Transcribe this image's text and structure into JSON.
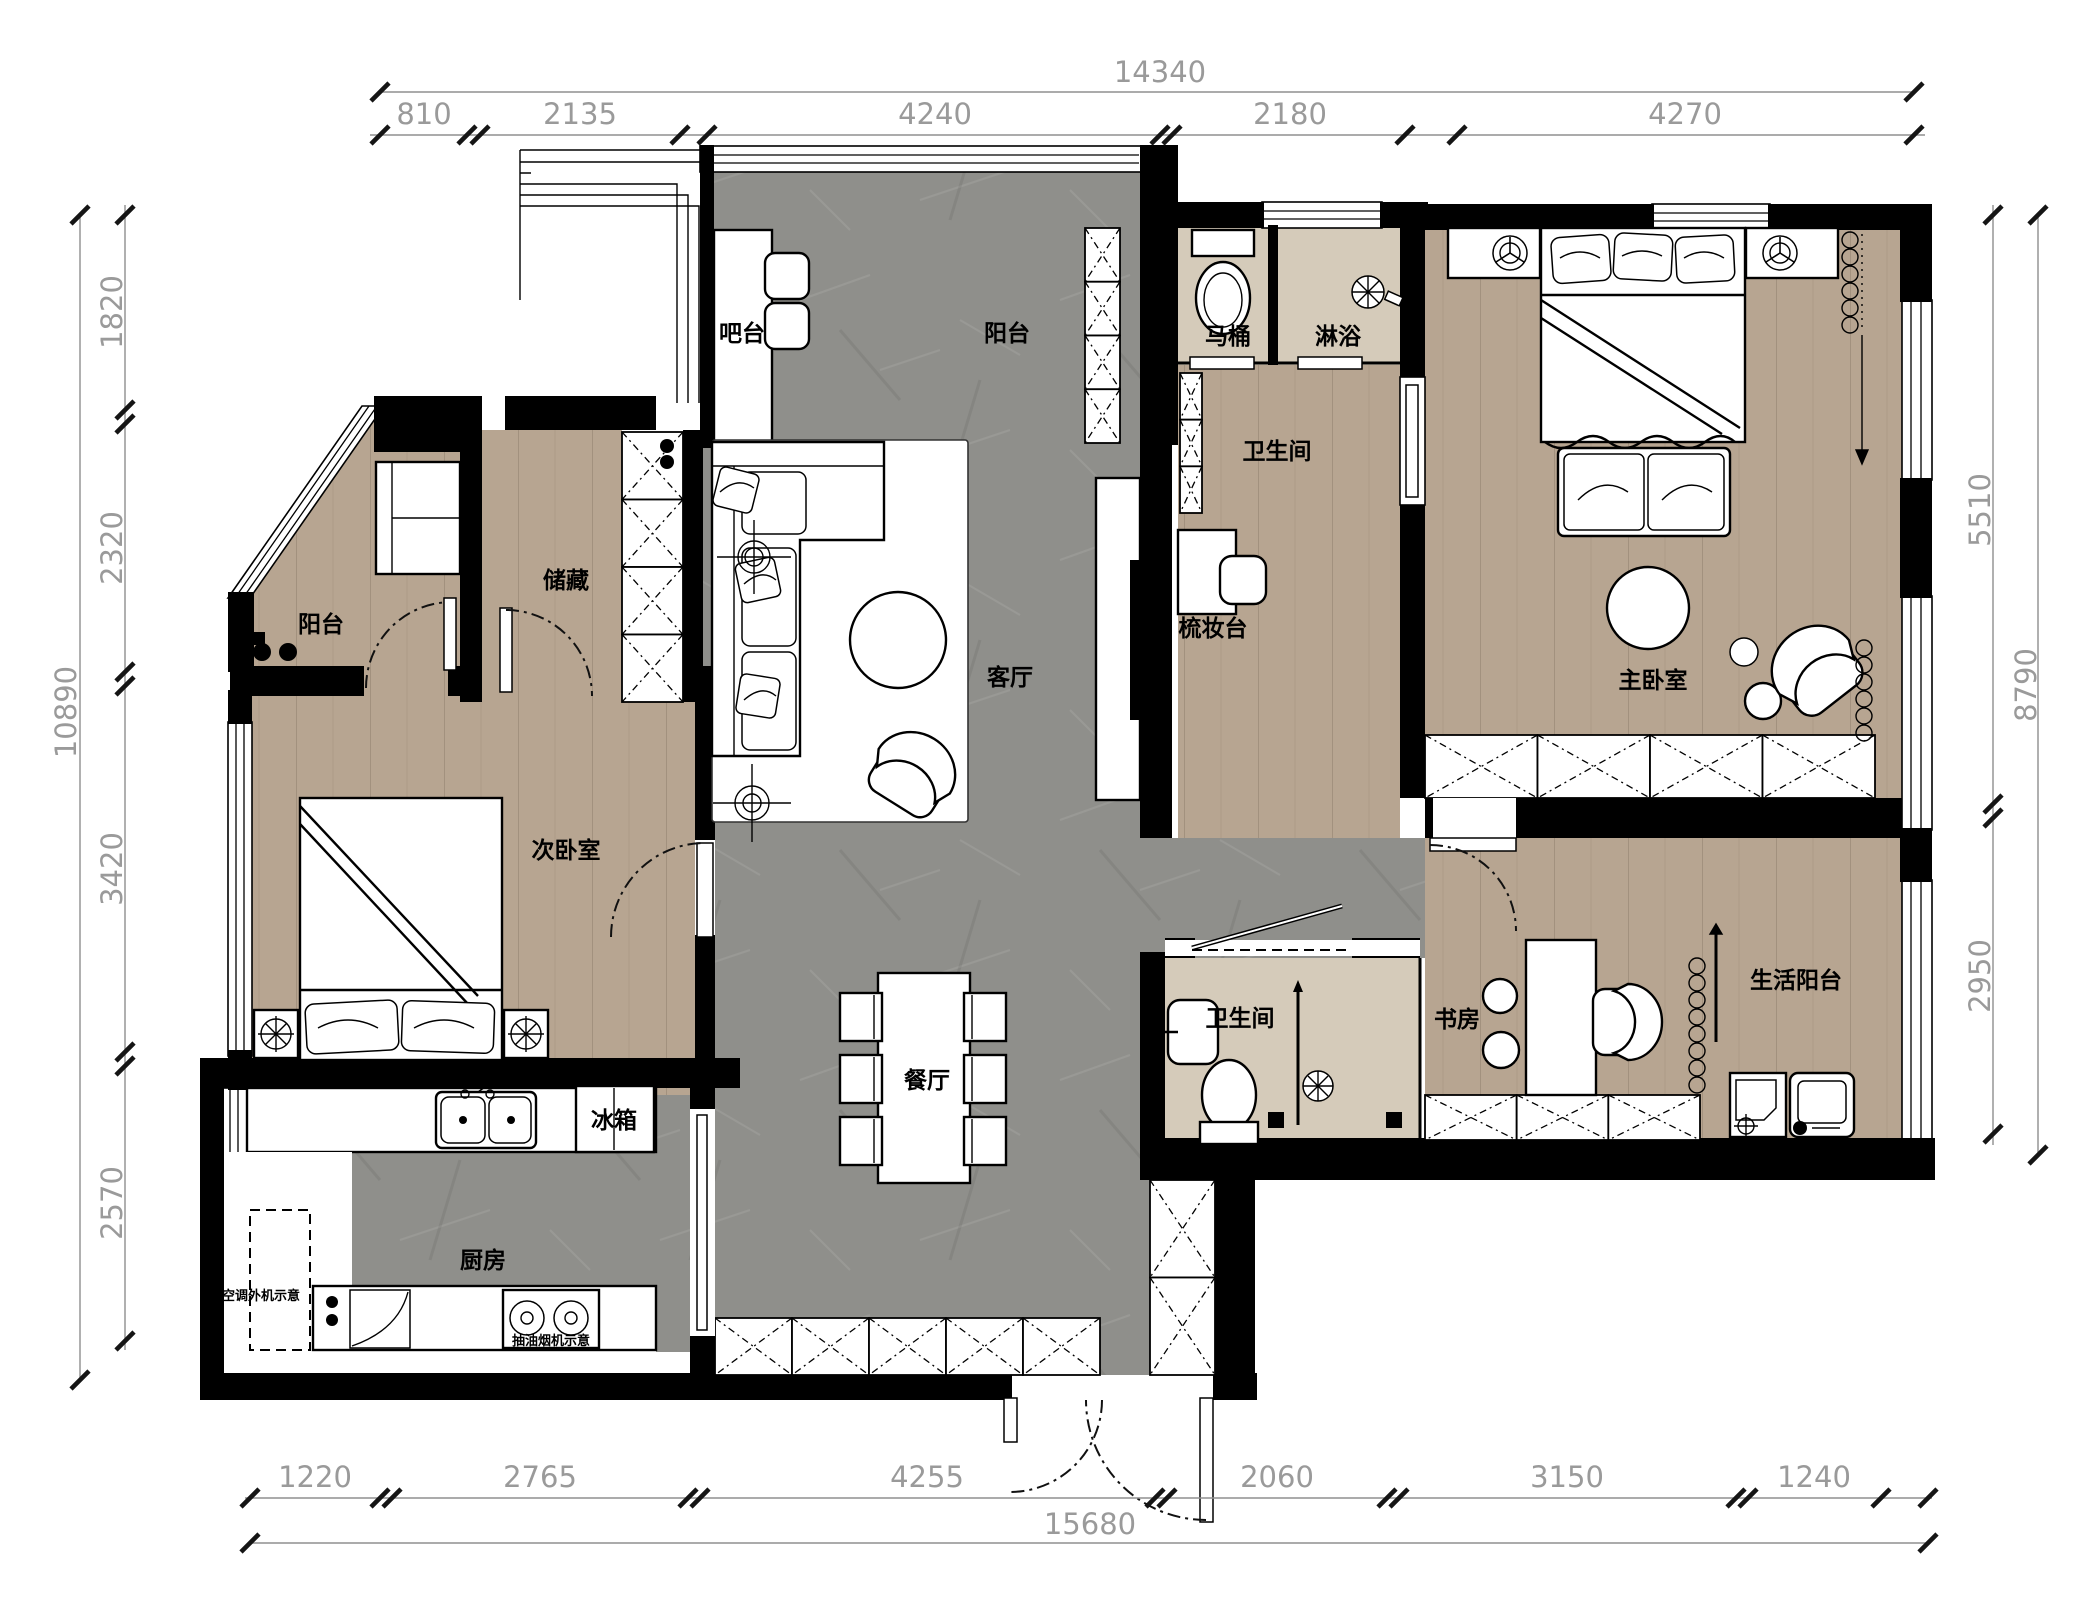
{
  "document": {
    "type": "apartment-floor-plan"
  },
  "colors": {
    "wall": "#000000",
    "wood": "#b7a591",
    "concrete": "#8f8f8b",
    "tile": "#d5cbba",
    "dim_line": "#8f8f8f",
    "dim_text": "#9a9a9a",
    "label": "#000000",
    "background": "#ffffff"
  },
  "rooms": {
    "balcony_top": "阳台",
    "living": "客厅",
    "dining": "餐厅",
    "kitchen": "厨房",
    "master_bedroom": "主卧室",
    "second_bedroom": "次卧室",
    "study": "书房",
    "service_balcony": "生活阳台",
    "storage": "储藏",
    "balcony_left": "阳台",
    "bathroom_master": "卫生间",
    "bathroom_guest": "卫生间",
    "toilet_room": "马桶",
    "shower_room": "淋浴"
  },
  "fixtures": {
    "bar": "吧台",
    "vanity": "梳妆台",
    "fridge": "冰箱",
    "ac_outdoor_unit": "空调外机示意",
    "range_hood": "抽油烟机示意"
  },
  "dimensions": {
    "top": {
      "overall": "14340",
      "segments": [
        "810",
        "2135",
        "4240",
        "2180",
        "4270"
      ]
    },
    "bottom": {
      "overall": "15680",
      "segments": [
        "1220",
        "2765",
        "4255",
        "2060",
        "3150",
        "1240"
      ]
    },
    "left": {
      "overall": "10890",
      "segments": [
        "1820",
        "2320",
        "3420",
        "2570"
      ]
    },
    "right": {
      "overall": "8790",
      "segments": [
        "5510",
        "2950"
      ]
    }
  }
}
